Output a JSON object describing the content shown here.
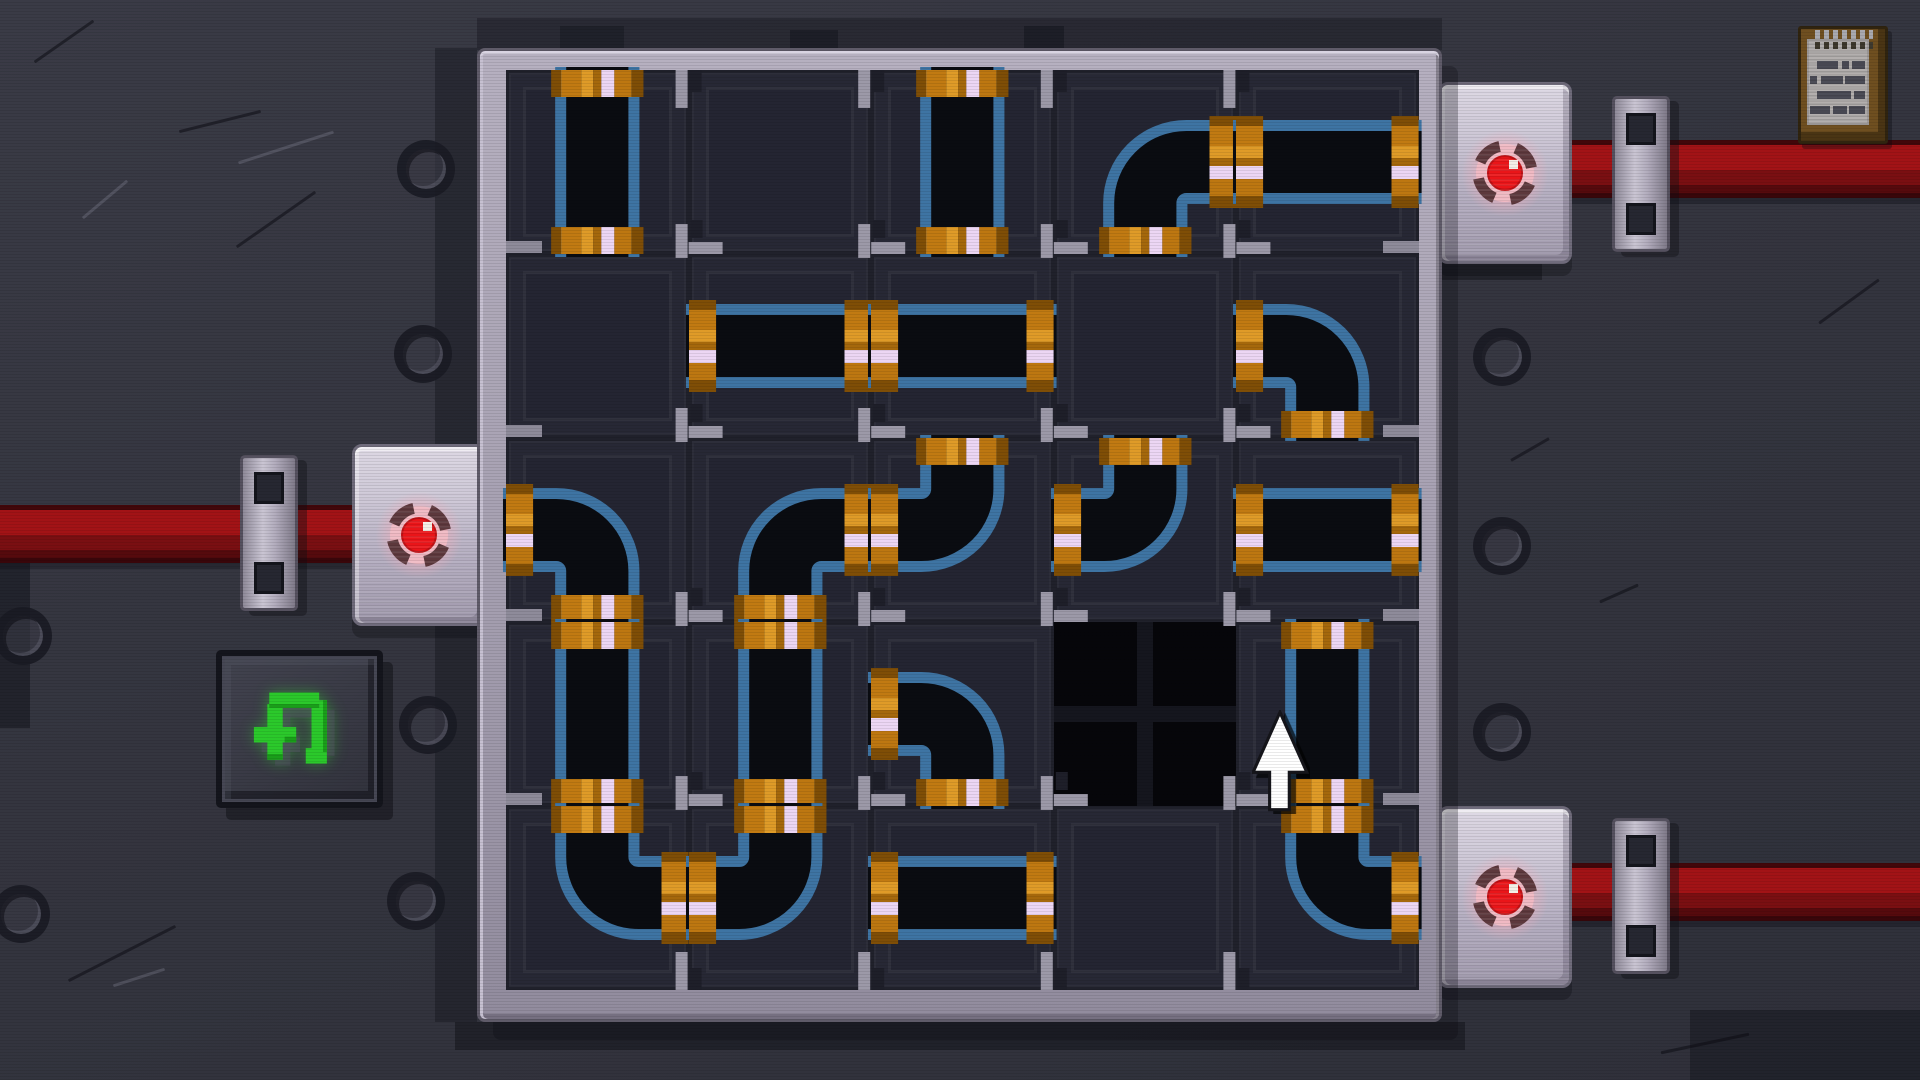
{
  "scene": {
    "name": "pipe-routing-puzzle",
    "description": "pixel-art pipe puzzle board on riveted metal wall"
  },
  "board": {
    "rows": 5,
    "cols": 5,
    "piece_legend": {
      "V": "vertical straight pipe",
      "H": "horizontal straight pipe",
      "TL": "elbow open top+left",
      "TR": "elbow open top+right",
      "LB": "elbow open left+bottom",
      "RB": "elbow open right+bottom",
      "HOLE": "empty black socket",
      "": "empty cell"
    },
    "cells": [
      [
        "V",
        "",
        "V",
        "RB",
        "H"
      ],
      [
        "",
        "H",
        "H",
        "",
        "LB"
      ],
      [
        "LB",
        "RB",
        "TL",
        "TL",
        "H"
      ],
      [
        "V",
        "V",
        "LB",
        "HOLE",
        "V"
      ],
      [
        "TR",
        "TL",
        "H",
        "",
        "TR"
      ]
    ],
    "wall_exits": [
      {
        "side": "right",
        "row": 1,
        "to": "valve-top-right"
      },
      {
        "side": "left",
        "row": 3,
        "to": "valve-left"
      },
      {
        "side": "right",
        "row": 5,
        "to": "valve-bottom-right"
      }
    ]
  },
  "valves": [
    {
      "id": "valve-left",
      "light": "red"
    },
    {
      "id": "valve-top-right",
      "light": "red"
    },
    {
      "id": "valve-bottom-right",
      "light": "red"
    }
  ],
  "controls": {
    "undo_icon": "undo-arrow-green",
    "notes_icon": "notepad"
  },
  "cursor": {
    "icon": "pixel-arrow-up",
    "x": 1256,
    "y": 714
  },
  "colors": {
    "wall": "#34353f",
    "frame_silver": "#a7a1b2",
    "cell_bg": "#272835",
    "pipe_black": "#0a0c11",
    "pipe_blue": "#3e74a3",
    "brass": "#c17a12",
    "brass_dark": "#7f4e06",
    "brass_light": "#df9b28",
    "lavender_stripe": "#ecd6f4",
    "red_pipe": "#a21316",
    "led_red": "#ea1519",
    "led_ring": "#5d383c",
    "led_pink": "#f0b9c3",
    "undo_green": "#2bc92b",
    "paper_tan": "#b3afae",
    "board_brown": "#6f4f20"
  },
  "decor": {
    "bolts": [
      {
        "x": 417,
        "y": 160
      },
      {
        "x": 414,
        "y": 345
      },
      {
        "x": 419,
        "y": 716
      },
      {
        "x": 407,
        "y": 892
      },
      {
        "x": 1493,
        "y": 348
      },
      {
        "x": 1493,
        "y": 537
      },
      {
        "x": 1493,
        "y": 723
      },
      {
        "x": 14,
        "y": 627
      },
      {
        "x": 12,
        "y": 905
      }
    ],
    "scratches": [
      {
        "x": 28,
        "y": 40,
        "len": 72,
        "ang": -35,
        "tone": "d"
      },
      {
        "x": 178,
        "y": 120,
        "len": 84,
        "ang": -14,
        "tone": "d"
      },
      {
        "x": 76,
        "y": 198,
        "len": 58,
        "ang": -40,
        "tone": "l"
      },
      {
        "x": 228,
        "y": 218,
        "len": 96,
        "ang": -35,
        "tone": "d"
      },
      {
        "x": 236,
        "y": 146,
        "len": 100,
        "ang": -18,
        "tone": "l"
      },
      {
        "x": 62,
        "y": 952,
        "len": 120,
        "ang": -27,
        "tone": "d"
      },
      {
        "x": 112,
        "y": 976,
        "len": 54,
        "ang": -18,
        "tone": "l"
      },
      {
        "x": 1508,
        "y": 448,
        "len": 44,
        "ang": -30,
        "tone": "d"
      },
      {
        "x": 1598,
        "y": 592,
        "len": 42,
        "ang": -24,
        "tone": "d"
      },
      {
        "x": 1812,
        "y": 300,
        "len": 74,
        "ang": -36,
        "tone": "d"
      },
      {
        "x": 1660,
        "y": 1042,
        "len": 90,
        "ang": -12,
        "tone": "d"
      }
    ],
    "patches": [
      {
        "x": 477,
        "y": 18,
        "w": 965,
        "h": 32,
        "c": "rgba(24,25,33,0.45)"
      },
      {
        "x": 790,
        "y": 30,
        "w": 48,
        "h": 22,
        "c": "rgba(18,19,27,0.5)"
      },
      {
        "x": 1024,
        "y": 26,
        "w": 40,
        "h": 26,
        "c": "rgba(18,19,27,0.5)"
      },
      {
        "x": 560,
        "y": 26,
        "w": 64,
        "h": 24,
        "c": "rgba(18,19,27,0.4)"
      },
      {
        "x": 435,
        "y": 48,
        "w": 42,
        "h": 974,
        "c": "rgba(24,25,33,0.5)"
      },
      {
        "x": 455,
        "y": 1022,
        "w": 1010,
        "h": 28,
        "c": "rgba(16,17,24,0.5)"
      },
      {
        "x": 1430,
        "y": 256,
        "w": 112,
        "h": 24,
        "c": "rgba(22,22,30,0.55)"
      },
      {
        "x": 1690,
        "y": 1010,
        "w": 230,
        "h": 70,
        "c": "rgba(20,21,29,0.5)"
      },
      {
        "x": 0,
        "y": 556,
        "w": 30,
        "h": 172,
        "c": "rgba(22,23,31,0.6)"
      }
    ],
    "notepad_lines": [
      [
        [
          0.16,
          0.34
        ],
        [
          0.56,
          0.12
        ],
        [
          0.72,
          0.22
        ]
      ],
      [
        [
          0.05,
          0.12
        ],
        [
          0.22,
          0.36
        ],
        [
          0.62,
          0.32
        ]
      ],
      [
        [
          0.16,
          0.55
        ],
        [
          0.76,
          0.18
        ]
      ],
      [
        [
          0.05,
          0.32
        ],
        [
          0.42,
          0.22
        ],
        [
          0.68,
          0.26
        ]
      ]
    ]
  }
}
